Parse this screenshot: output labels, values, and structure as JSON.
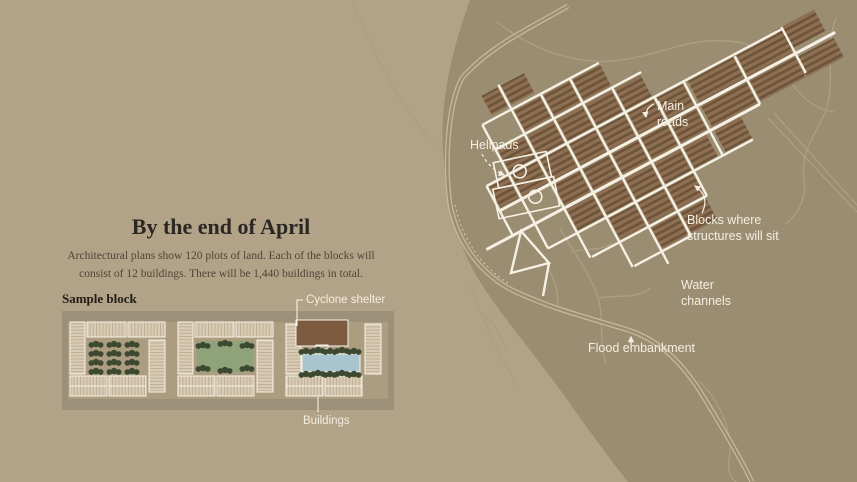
{
  "infographic": {
    "left_panel": {
      "title": "By the end of April",
      "description_line1": "Architectural plans show 120 plots of land. Each of the blocks will",
      "description_line2": "consist of 12 buildings. There will be 1,440 buildings in total.",
      "sample_block": {
        "heading": "Sample block",
        "labels": {
          "cyclone_shelter": "Cyclone shelter",
          "buildings": "Buildings"
        }
      }
    },
    "map": {
      "labels": {
        "helipads": "Helipads",
        "main_roads": [
          "Main",
          "roads"
        ],
        "blocks": [
          "Blocks where",
          "structures will sit"
        ],
        "water_channels": [
          "Water",
          "channels"
        ],
        "flood_embankment": "Flood embankment"
      }
    },
    "colors": {
      "page_background": "#b2a287",
      "terrain": "#9a8d71",
      "roads": "#f6f1e4",
      "building_blocks": "#8d7053",
      "building_block_stripes": "#6e5339",
      "map_labels": "#f4eee1",
      "title_text": "#2b2723",
      "body_text": "#4e4639",
      "sample_buildings": "#d9ccb6",
      "trees": "#3c4930",
      "courtyard_green": "#8fa37b",
      "pond": "#a9c6ce",
      "cyclone_shelter": "#7d5b41",
      "road_frame": "#9c9078",
      "flood_embankment": "#c7b997",
      "water_channels": "#ac9e80"
    }
  }
}
